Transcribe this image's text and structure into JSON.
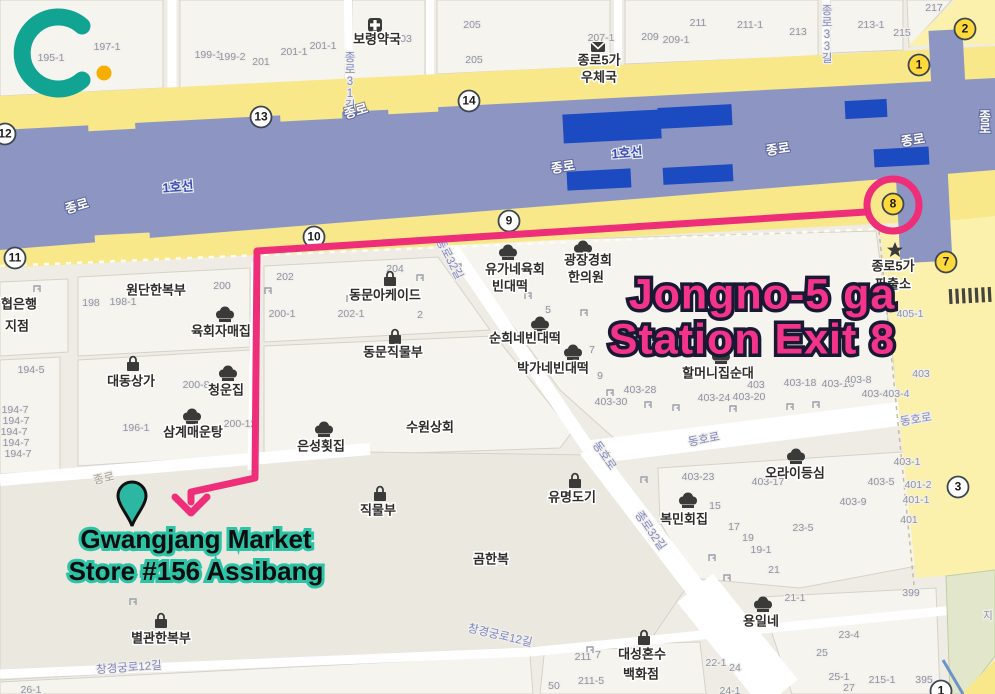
{
  "branding": {
    "logo_letter": "C",
    "logo_color": "#12a493",
    "logo_dot_color": "#f6ae00"
  },
  "annotations": {
    "station_label": {
      "line1": "Jongno-5 ga",
      "line2": "Station Exit 8",
      "color": "#f4348b",
      "outline": "#191934"
    },
    "destination_label": {
      "line1": "Gwangjang Market",
      "line2": "Store #156 Assibang",
      "fill": "#0d0d0d",
      "outline": "#2cc3a6"
    },
    "route_color": "#ee2e79",
    "pin_color": "#2bb7a1"
  },
  "map": {
    "colors": {
      "road_yellow": "#f8e88a",
      "road_pale": "#fbf1ac",
      "subway_light": "#8d96c3",
      "subway_dark": "#1c4ac0",
      "park_green": "#e2e7cb",
      "background": "#eeece5"
    },
    "subway_labels": [
      {
        "t": "1호선",
        "x": 178,
        "y": 188,
        "r": -4,
        "c": "sub"
      },
      {
        "t": "1호선",
        "x": 627,
        "y": 154,
        "r": -4,
        "c": "sub"
      },
      {
        "t": "종로",
        "x": 77,
        "y": 207,
        "r": -16,
        "c": "subw"
      },
      {
        "t": "종로",
        "x": 356,
        "y": 112,
        "r": -16,
        "c": "subw"
      },
      {
        "t": "종로",
        "x": 563,
        "y": 168,
        "r": -8,
        "c": "subw"
      },
      {
        "t": "종로",
        "x": 778,
        "y": 150,
        "r": -8,
        "c": "subw"
      },
      {
        "t": "종로",
        "x": 913,
        "y": 141,
        "r": -8,
        "c": "subw"
      },
      {
        "t": "종로",
        "x": 985,
        "y": 112,
        "v": 1,
        "c": "subw"
      }
    ],
    "street_labels": [
      {
        "t": "종로31길",
        "x": 350,
        "y": 52,
        "v": 1,
        "c": "st"
      },
      {
        "t": "종로33길",
        "x": 827,
        "y": 5,
        "v": 1,
        "c": "st"
      },
      {
        "t": "종로32길",
        "x": 449,
        "y": 259,
        "r": 62,
        "c": "st"
      },
      {
        "t": "종로32길",
        "x": 650,
        "y": 531,
        "r": 55,
        "c": "st"
      },
      {
        "t": "동호로",
        "x": 704,
        "y": 440,
        "r": -11,
        "c": "st"
      },
      {
        "t": "동호로",
        "x": 916,
        "y": 420,
        "r": -9,
        "c": "st"
      },
      {
        "t": "동호로",
        "x": 604,
        "y": 456,
        "r": 55,
        "c": "st"
      },
      {
        "t": "창경궁로12길",
        "x": 129,
        "y": 668,
        "r": -4,
        "c": "st"
      },
      {
        "t": "창경궁로12길",
        "x": 500,
        "y": 636,
        "r": 13,
        "c": "st"
      },
      {
        "t": "종로",
        "x": 104,
        "y": 479,
        "r": -13,
        "c": "stg"
      }
    ],
    "lot_numbers": [
      {
        "t": "195-1",
        "x": 51,
        "y": 58
      },
      {
        "t": "197-1",
        "x": 107,
        "y": 47
      },
      {
        "t": "199-1",
        "x": 208,
        "y": 55
      },
      {
        "t": "199-2",
        "x": 232,
        "y": 57
      },
      {
        "t": "201",
        "x": 261,
        "y": 62
      },
      {
        "t": "201-1",
        "x": 294,
        "y": 52
      },
      {
        "t": "201-1",
        "x": 323,
        "y": 46
      },
      {
        "t": "03",
        "x": 406,
        "y": 39
      },
      {
        "t": "205",
        "x": 472,
        "y": 25
      },
      {
        "t": "205",
        "x": 474,
        "y": 60
      },
      {
        "t": "207-1",
        "x": 601,
        "y": 38
      },
      {
        "t": "209",
        "x": 650,
        "y": 37
      },
      {
        "t": "209-1",
        "x": 676,
        "y": 40
      },
      {
        "t": "211",
        "x": 698,
        "y": 23
      },
      {
        "t": "211-1",
        "x": 750,
        "y": 25
      },
      {
        "t": "213",
        "x": 798,
        "y": 32
      },
      {
        "t": "213-1",
        "x": 871,
        "y": 25
      },
      {
        "t": "215",
        "x": 902,
        "y": 33
      },
      {
        "t": "217",
        "x": 934,
        "y": 8
      },
      {
        "t": "198",
        "x": 91,
        "y": 303
      },
      {
        "t": "198-1",
        "x": 123,
        "y": 302
      },
      {
        "t": "200",
        "x": 222,
        "y": 286
      },
      {
        "t": "202",
        "x": 285,
        "y": 277
      },
      {
        "t": "200-1",
        "x": 282,
        "y": 314
      },
      {
        "t": "202-1",
        "x": 351,
        "y": 314
      },
      {
        "t": "204",
        "x": 395,
        "y": 269
      },
      {
        "t": "2",
        "x": 420,
        "y": 315
      },
      {
        "t": "194-5",
        "x": 31,
        "y": 370
      },
      {
        "t": "196-1",
        "x": 136,
        "y": 428
      },
      {
        "t": "194-7",
        "x": 15,
        "y": 410
      },
      {
        "t": "194-7",
        "x": 16,
        "y": 421
      },
      {
        "t": "194-7",
        "x": 14,
        "y": 432
      },
      {
        "t": "194-7",
        "x": 16,
        "y": 443
      },
      {
        "t": "194-7",
        "x": 18,
        "y": 454
      },
      {
        "t": "200-8",
        "x": 196,
        "y": 385
      },
      {
        "t": "200-12",
        "x": 240,
        "y": 424
      },
      {
        "t": "5",
        "x": 548,
        "y": 310
      },
      {
        "t": "7",
        "x": 592,
        "y": 350
      },
      {
        "t": "9",
        "x": 600,
        "y": 376
      },
      {
        "t": "403-30",
        "x": 611,
        "y": 402
      },
      {
        "t": "403-28",
        "x": 640,
        "y": 390
      },
      {
        "t": "403-24",
        "x": 714,
        "y": 398
      },
      {
        "t": "403-20",
        "x": 749,
        "y": 397
      },
      {
        "t": "403",
        "x": 756,
        "y": 385
      },
      {
        "t": "403-18",
        "x": 800,
        "y": 383
      },
      {
        "t": "403-16",
        "x": 838,
        "y": 384
      },
      {
        "t": "403-8",
        "x": 858,
        "y": 380
      },
      {
        "t": "403-6",
        "x": 875,
        "y": 394
      },
      {
        "t": "403-4",
        "x": 896,
        "y": 394
      },
      {
        "t": "403",
        "x": 921,
        "y": 374
      },
      {
        "t": "405-1",
        "x": 910,
        "y": 314
      },
      {
        "t": "403-1",
        "x": 907,
        "y": 462
      },
      {
        "t": "403-23",
        "x": 698,
        "y": 477
      },
      {
        "t": "403-17",
        "x": 768,
        "y": 482
      },
      {
        "t": "403-9",
        "x": 853,
        "y": 502
      },
      {
        "t": "403-5",
        "x": 881,
        "y": 482
      },
      {
        "t": "401-2",
        "x": 918,
        "y": 485
      },
      {
        "t": "401-1",
        "x": 916,
        "y": 500
      },
      {
        "t": "401",
        "x": 909,
        "y": 520
      },
      {
        "t": "15",
        "x": 715,
        "y": 506
      },
      {
        "t": "17",
        "x": 734,
        "y": 527
      },
      {
        "t": "19",
        "x": 748,
        "y": 538
      },
      {
        "t": "19-1",
        "x": 761,
        "y": 550
      },
      {
        "t": "21",
        "x": 774,
        "y": 570
      },
      {
        "t": "23-5",
        "x": 803,
        "y": 528
      },
      {
        "t": "211",
        "x": 583,
        "y": 657
      },
      {
        "t": "7",
        "x": 598,
        "y": 655
      },
      {
        "t": "211-5",
        "x": 591,
        "y": 681
      },
      {
        "t": "50",
        "x": 554,
        "y": 686
      },
      {
        "t": "26-1",
        "x": 31,
        "y": 690
      },
      {
        "t": "22-1",
        "x": 716,
        "y": 663
      },
      {
        "t": "24",
        "x": 735,
        "y": 668
      },
      {
        "t": "24-1",
        "x": 730,
        "y": 691
      },
      {
        "t": "21-1",
        "x": 795,
        "y": 598
      },
      {
        "t": "23-4",
        "x": 849,
        "y": 635
      },
      {
        "t": "25",
        "x": 822,
        "y": 653
      },
      {
        "t": "25-1",
        "x": 839,
        "y": 677
      },
      {
        "t": "27",
        "x": 849,
        "y": 688
      },
      {
        "t": "215-1",
        "x": 882,
        "y": 680
      },
      {
        "t": "395",
        "x": 924,
        "y": 680
      },
      {
        "t": "399",
        "x": 911,
        "y": 593
      },
      {
        "t": "지",
        "x": 988,
        "y": 616
      }
    ],
    "poi_texts": [
      {
        "t": "보령약국",
        "x": 377,
        "y": 40
      },
      {
        "t": "종로5가",
        "x": 599,
        "y": 61
      },
      {
        "t": "우체국",
        "x": 599,
        "y": 78
      },
      {
        "t": "원단한복부",
        "x": 156,
        "y": 291
      },
      {
        "t": "육회자매집",
        "x": 221,
        "y": 332
      },
      {
        "t": "대동상가",
        "x": 131,
        "y": 382
      },
      {
        "t": "청운집",
        "x": 226,
        "y": 391
      },
      {
        "t": "삼계매운탕",
        "x": 193,
        "y": 433
      },
      {
        "t": "동문아케이드",
        "x": 385,
        "y": 296
      },
      {
        "t": "동문직물부",
        "x": 393,
        "y": 353
      },
      {
        "t": "은성횟집",
        "x": 321,
        "y": 447
      },
      {
        "t": "수원상회",
        "x": 430,
        "y": 428
      },
      {
        "t": "유가네육회",
        "x": 515,
        "y": 270
      },
      {
        "t": "빈대떡",
        "x": 510,
        "y": 287
      },
      {
        "t": "광장경희",
        "x": 588,
        "y": 261
      },
      {
        "t": "한의원",
        "x": 586,
        "y": 278
      },
      {
        "t": "순희네빈대떡",
        "x": 525,
        "y": 339
      },
      {
        "t": "박가네빈대떡",
        "x": 553,
        "y": 369
      },
      {
        "t": "할머니집순대",
        "x": 718,
        "y": 374
      },
      {
        "t": "종로5가",
        "x": 893,
        "y": 267
      },
      {
        "t": "파출소",
        "x": 893,
        "y": 285
      },
      {
        "t": "오라이등심",
        "x": 795,
        "y": 474
      },
      {
        "t": "복민회집",
        "x": 684,
        "y": 520
      },
      {
        "t": "유명도기",
        "x": 572,
        "y": 498
      },
      {
        "t": "직물부",
        "x": 378,
        "y": 511
      },
      {
        "t": "곰한복",
        "x": 491,
        "y": 560
      },
      {
        "t": "별관한복부",
        "x": 161,
        "y": 639
      },
      {
        "t": "대성혼수",
        "x": 642,
        "y": 655
      },
      {
        "t": "백화점",
        "x": 641,
        "y": 675
      },
      {
        "t": "용일네",
        "x": 761,
        "y": 622
      },
      {
        "t": "협은행",
        "x": 19,
        "y": 305
      },
      {
        "t": "지점",
        "x": 17,
        "y": 327
      }
    ],
    "poi_icons": [
      {
        "k": "pharmacy",
        "x": 375,
        "y": 25
      },
      {
        "k": "mail",
        "x": 598,
        "y": 47
      },
      {
        "k": "police",
        "x": 895,
        "y": 250
      },
      {
        "k": "chef",
        "x": 225,
        "y": 315
      },
      {
        "k": "bag",
        "x": 133,
        "y": 364
      },
      {
        "k": "chef",
        "x": 228,
        "y": 374
      },
      {
        "k": "chef",
        "x": 192,
        "y": 417
      },
      {
        "k": "bag",
        "x": 390,
        "y": 279
      },
      {
        "k": "bag",
        "x": 395,
        "y": 337
      },
      {
        "k": "chef",
        "x": 324,
        "y": 430
      },
      {
        "k": "chef",
        "x": 508,
        "y": 253
      },
      {
        "k": "chef",
        "x": 583,
        "y": 249
      },
      {
        "k": "chef",
        "x": 540,
        "y": 325
      },
      {
        "k": "chef",
        "x": 573,
        "y": 353
      },
      {
        "k": "chef",
        "x": 721,
        "y": 357
      },
      {
        "k": "chef",
        "x": 796,
        "y": 457
      },
      {
        "k": "chef",
        "x": 688,
        "y": 501
      },
      {
        "k": "bag",
        "x": 575,
        "y": 481
      },
      {
        "k": "bag",
        "x": 380,
        "y": 494
      },
      {
        "k": "bag",
        "x": 161,
        "y": 621
      },
      {
        "k": "bag",
        "x": 644,
        "y": 638
      },
      {
        "k": "chef",
        "x": 763,
        "y": 605
      }
    ],
    "exits": [
      {
        "n": "12",
        "x": 5,
        "y": 134
      },
      {
        "n": "13",
        "x": 261,
        "y": 117
      },
      {
        "n": "14",
        "x": 469,
        "y": 101
      },
      {
        "n": "9",
        "x": 509,
        "y": 221
      },
      {
        "n": "10",
        "x": 314,
        "y": 237
      },
      {
        "n": "11",
        "x": 15,
        "y": 258
      },
      {
        "n": "8",
        "x": 893,
        "y": 204,
        "yl": 1
      },
      {
        "n": "7",
        "x": 946,
        "y": 262,
        "yl": 1
      },
      {
        "n": "1",
        "x": 919,
        "y": 65,
        "yl": 1
      },
      {
        "n": "2",
        "x": 965,
        "y": 29,
        "yl": 1
      },
      {
        "n": "3",
        "x": 958,
        "y": 487
      },
      {
        "n": "1",
        "x": 941,
        "y": 691
      }
    ],
    "doors": [
      [
        37,
        289
      ],
      [
        268,
        291
      ],
      [
        420,
        278
      ],
      [
        458,
        267
      ],
      [
        584,
        313
      ],
      [
        610,
        393
      ],
      [
        648,
        405
      ],
      [
        676,
        408
      ],
      [
        733,
        409
      ],
      [
        790,
        407
      ],
      [
        816,
        405
      ],
      [
        644,
        480
      ],
      [
        712,
        558
      ],
      [
        727,
        578
      ],
      [
        133,
        602
      ],
      [
        590,
        650
      ],
      [
        350,
        299
      ],
      [
        528,
        296
      ]
    ]
  }
}
